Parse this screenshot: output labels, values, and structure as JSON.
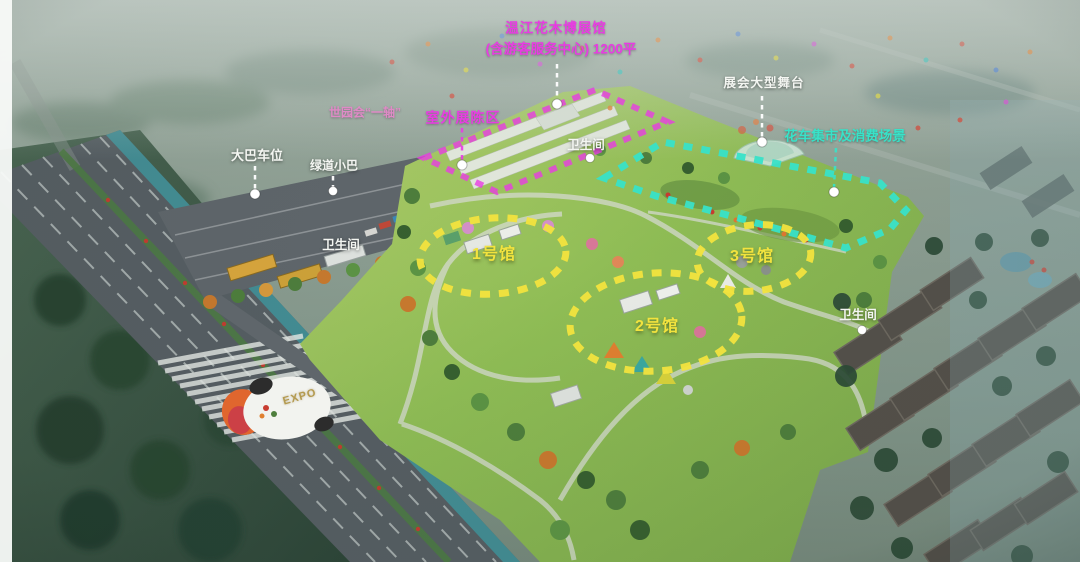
{
  "annotations": {
    "main_hall": {
      "line1": "温江花木博展馆",
      "line2": "(含游客服务中心) 1200平"
    },
    "stage_label": "展会大型舞台",
    "axis_label": "世园会“一轴”",
    "outdoor_exhibit_label": "室外展陈区",
    "float_market_label": "花车集市及消费场景",
    "bus_parking_label": "大巴车位",
    "greenway_bus_label": "绿道小巴",
    "toilet_top_label": "卫生间",
    "toilet_parking_label": "卫生间",
    "toilet_southeast_label": "卫生间",
    "hall1_label": "1号馆",
    "hall2_label": "2号馆",
    "hall3_label": "3号馆"
  },
  "ground_art": {
    "expo_text": "EXPO"
  },
  "colors": {
    "magenta": "#e83ce2",
    "pink": "#df8ac6",
    "cyan": "#38e2c8",
    "yellow": "#f2e33e",
    "label-white": "#f4f6f2"
  }
}
